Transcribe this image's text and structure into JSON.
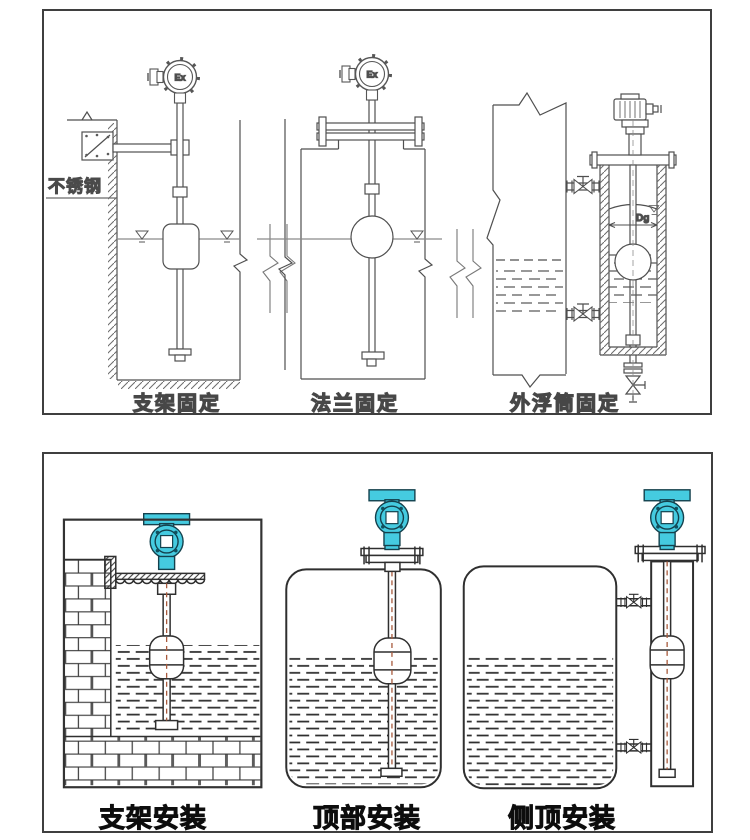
{
  "page": {
    "background": "#ffffff"
  },
  "colors": {
    "accent_cyan": "#45cbe0",
    "line_gray": "#4f4f4f",
    "line_dark": "#2f2f2f",
    "center_line_red": "#a85a3c"
  },
  "top_panel": {
    "labels": {
      "stainless_steel": "不锈钢",
      "ex_marking": "Ex",
      "diameter_dg": "Dg"
    },
    "figures": [
      {
        "caption": "支架固定"
      },
      {
        "caption": "法兰固定"
      },
      {
        "caption": "外浮筒固定"
      }
    ]
  },
  "bottom_panel": {
    "figures": [
      {
        "caption": "支架安装"
      },
      {
        "caption": "顶部安装"
      },
      {
        "caption": "侧顶安装"
      }
    ]
  }
}
